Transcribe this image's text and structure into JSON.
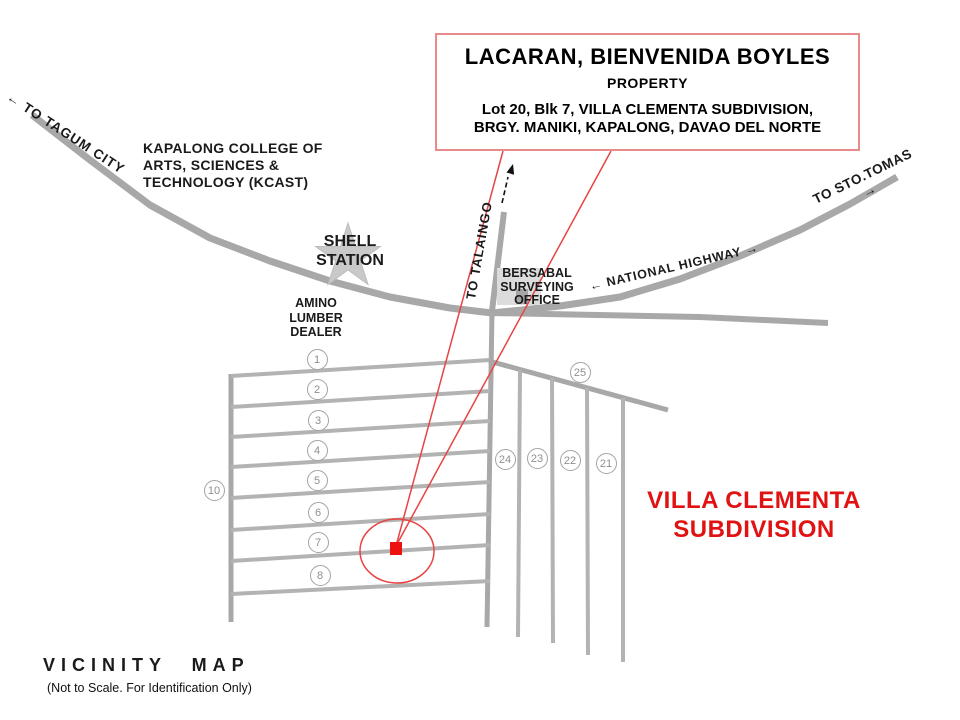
{
  "callout_box": {
    "title": "LACARAN, BIENVENIDA BOYLES",
    "subtitle": "PROPERTY",
    "address": "Lot 20, Blk 7, VILLA CLEMENTA SUBDIVISION,\nBRGY. MANIKI, KAPALONG, DAVAO DEL NORTE"
  },
  "labels": {
    "to_tagum_city": "← TO TAGUM CITY",
    "kcast": "KAPALONG COLLEGE OF\nARTS, SCIENCES &\nTECHNOLOGY (KCAST)",
    "shell_station": "SHELL\nSTATION",
    "amino_lumber": "AMINO\nLUMBER\nDEALER",
    "to_talaingo": "TO  TALAINGO",
    "bersabal": "BERSABAL\nSURVEYING\nOFFICE",
    "national_highway": "← NATIONAL HIGHWAY →",
    "to_sto_tomas": "TO STO.TOMAS →",
    "subdivision_name": "VILLA CLEMENTA\nSUBDIVISION"
  },
  "footer": {
    "map_title": "VICINITY MAP",
    "note": "(Not to Scale. For Identification Only)"
  },
  "lot_markers": [
    {
      "label": "1",
      "x": 317,
      "y": 359
    },
    {
      "label": "2",
      "x": 317,
      "y": 389
    },
    {
      "label": "3",
      "x": 318,
      "y": 420
    },
    {
      "label": "4",
      "x": 317,
      "y": 450
    },
    {
      "label": "5",
      "x": 317,
      "y": 480
    },
    {
      "label": "6",
      "x": 318,
      "y": 512
    },
    {
      "label": "7",
      "x": 318,
      "y": 542
    },
    {
      "label": "8",
      "x": 320,
      "y": 575
    },
    {
      "label": "10",
      "x": 214,
      "y": 490
    },
    {
      "label": "25",
      "x": 580,
      "y": 372
    },
    {
      "label": "24",
      "x": 505,
      "y": 459
    },
    {
      "label": "23",
      "x": 537,
      "y": 458
    },
    {
      "label": "22",
      "x": 570,
      "y": 460
    },
    {
      "label": "21",
      "x": 606,
      "y": 463
    }
  ],
  "colors": {
    "road_gray": "#a8a8a8",
    "block_road_gray": "#b3b3b3",
    "star_gray": "#c9c9c9",
    "callout_border_red": "#e98b8b",
    "pointer_red": "#e84444",
    "property_marker_red": "#ee1111",
    "subdivision_text_red": "#e01212"
  }
}
